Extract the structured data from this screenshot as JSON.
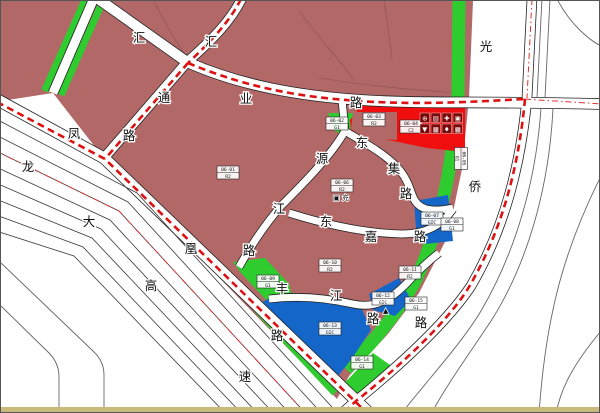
{
  "palette": {
    "residential": "#b36868",
    "green_space": "#2ecc2e",
    "institution_blue": "#1467c8",
    "commercial_red": "#f10e0e",
    "boundary_red": "#dd1111",
    "road_fill": "#ffffff",
    "parcel_line": "#8a5050",
    "bottom_strip_tan": "#c9b97a"
  },
  "roads": [
    {
      "id": "fenghuang-road",
      "name": "凤凰路",
      "chars": [
        {
          "c": "凤",
          "x": 73,
          "y": 133
        },
        {
          "c": "凰",
          "x": 190,
          "y": 248
        },
        {
          "c": "路",
          "x": 276,
          "y": 335
        }
      ]
    },
    {
      "id": "longda-expressway",
      "name": "龙大高速",
      "chars": [
        {
          "c": "龙",
          "x": 27,
          "y": 166
        },
        {
          "c": "大",
          "x": 88,
          "y": 221
        },
        {
          "c": "高",
          "x": 150,
          "y": 285
        },
        {
          "c": "速",
          "x": 244,
          "y": 376
        }
      ]
    },
    {
      "id": "huiye-road",
      "name": "汇业路",
      "chars": [
        {
          "c": "汇",
          "x": 138,
          "y": 37
        },
        {
          "c": "业",
          "x": 245,
          "y": 98
        },
        {
          "c": "路",
          "x": 355,
          "y": 102
        }
      ]
    },
    {
      "id": "huitong-road",
      "name": "汇通路",
      "chars": [
        {
          "c": "汇",
          "x": 210,
          "y": 41
        },
        {
          "c": "通",
          "x": 163,
          "y": 97
        },
        {
          "c": "路",
          "x": 128,
          "y": 135
        }
      ]
    },
    {
      "id": "guangqiao-road",
      "name": "光侨路",
      "chars": [
        {
          "c": "光",
          "x": 485,
          "y": 46
        },
        {
          "c": "侨",
          "x": 474,
          "y": 186
        },
        {
          "c": "路",
          "x": 420,
          "y": 322
        }
      ]
    },
    {
      "id": "yuanjiang-road",
      "name": "源江路",
      "chars": [
        {
          "c": "源",
          "x": 321,
          "y": 158
        },
        {
          "c": "江",
          "x": 278,
          "y": 208
        },
        {
          "c": "路",
          "x": 248,
          "y": 250
        }
      ]
    },
    {
      "id": "dongji-road",
      "name": "东集路",
      "chars": [
        {
          "c": "东",
          "x": 361,
          "y": 142
        },
        {
          "c": "集",
          "x": 393,
          "y": 168
        },
        {
          "c": "路",
          "x": 405,
          "y": 193
        }
      ]
    },
    {
      "id": "dongjia-road",
      "name": "东嘉路",
      "chars": [
        {
          "c": "东",
          "x": 325,
          "y": 221
        },
        {
          "c": "嘉",
          "x": 370,
          "y": 236
        },
        {
          "c": "路",
          "x": 419,
          "y": 236
        }
      ]
    },
    {
      "id": "fengjiang-road",
      "name": "丰江路",
      "chars": [
        {
          "c": "丰",
          "x": 281,
          "y": 288
        },
        {
          "c": "江",
          "x": 335,
          "y": 295
        },
        {
          "c": "路",
          "x": 372,
          "y": 318
        }
      ]
    }
  ],
  "parcels": [
    {
      "code": "06-01",
      "type": "R2",
      "x": 216,
      "y": 165,
      "rot": 0
    },
    {
      "code": "06-02",
      "type": "G1",
      "x": 325,
      "y": 116,
      "rot": 0
    },
    {
      "code": "06-03",
      "type": "R2",
      "x": 362,
      "y": 112,
      "rot": 0
    },
    {
      "code": "06-04",
      "type": "C2",
      "x": 399,
      "y": 119,
      "rot": 0
    },
    {
      "code": "06-05",
      "type": "G1",
      "x": 449,
      "y": 151,
      "rot": 90
    },
    {
      "code": "06-06",
      "type": "R2",
      "x": 330,
      "y": 178,
      "rot": 0
    },
    {
      "code": "06-07",
      "type": "GIC",
      "x": 420,
      "y": 211,
      "rot": 0
    },
    {
      "code": "06-08",
      "type": "G1",
      "x": 440,
      "y": 217,
      "rot": 0
    },
    {
      "code": "06-09",
      "type": "G1",
      "x": 256,
      "y": 274,
      "rot": 0
    },
    {
      "code": "06-10",
      "type": "R2",
      "x": 318,
      "y": 258,
      "rot": 0
    },
    {
      "code": "06-11",
      "type": "R2",
      "x": 398,
      "y": 265,
      "rot": 0
    },
    {
      "code": "06-12",
      "type": "GIC",
      "x": 371,
      "y": 291,
      "rot": 0
    },
    {
      "code": "06-13",
      "type": "GIC",
      "x": 318,
      "y": 321,
      "rot": 0
    },
    {
      "code": "06-14",
      "type": "G1",
      "x": 350,
      "y": 355,
      "rot": 0
    },
    {
      "code": "06-15",
      "type": "G1",
      "x": 404,
      "y": 296,
      "rot": 0
    }
  ],
  "facility_icons": {
    "x": 419,
    "y": 112,
    "rows": [
      [
        "⊕",
        "▤",
        "✚",
        "▣"
      ],
      [
        "▼",
        "▦",
        "♦",
        "▩"
      ]
    ]
  },
  "poi_labels": [
    {
      "glyph": "▣",
      "text": "充",
      "x": 332,
      "y": 199
    },
    {
      "glyph": "▲",
      "text": "",
      "x": 382,
      "y": 312
    }
  ]
}
